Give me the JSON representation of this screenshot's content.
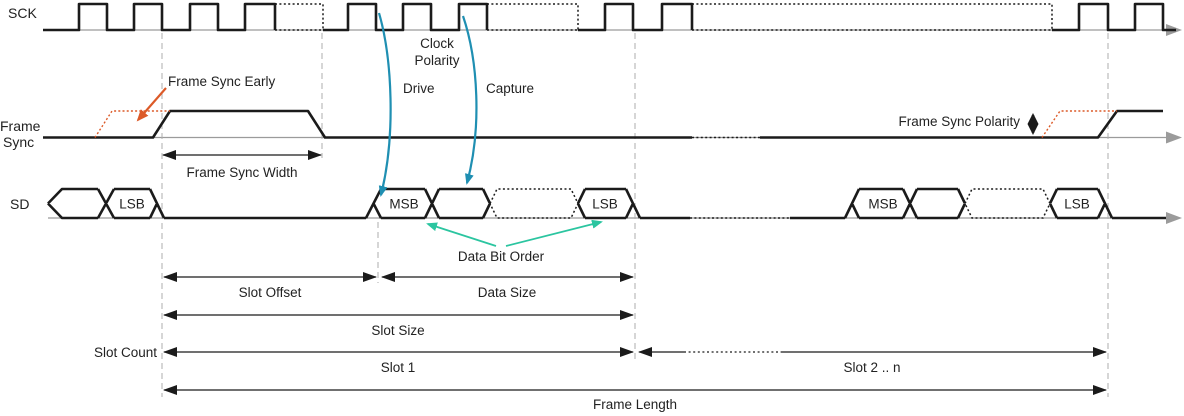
{
  "diagram": {
    "rows": {
      "sck": "SCK",
      "frame_line1": "Frame",
      "frame_line2": "Sync",
      "sd": "SD"
    },
    "annotations": {
      "frame_sync_early": "Frame Sync Early",
      "clock_polarity_line1": "Clock",
      "clock_polarity_line2": "Polarity",
      "drive": "Drive",
      "capture": "Capture",
      "frame_sync_width": "Frame Sync Width",
      "frame_sync_polarity": "Frame Sync Polarity",
      "data_bit_order": "Data Bit Order"
    },
    "cells": {
      "left_lsb": "LSB",
      "slot1_msb": "MSB",
      "slot1_lsb": "LSB",
      "slotn_msb": "MSB",
      "slotn_lsb": "LSB"
    },
    "dimensions": {
      "slot_offset": "Slot Offset",
      "data_size": "Data Size",
      "slot_size": "Slot Size",
      "slot_count": "Slot Count",
      "slot_1": "Slot 1",
      "slot_2_n": "Slot 2 .. n",
      "frame_length": "Frame Length"
    },
    "colors": {
      "signal": "#1b1b1b",
      "axis_gray": "#9b9b9b",
      "grid_gray": "#aeaeae",
      "accent_orange": "#dc5a28",
      "accent_blue": "#1f8fb2",
      "accent_green": "#2bc5a0"
    }
  }
}
